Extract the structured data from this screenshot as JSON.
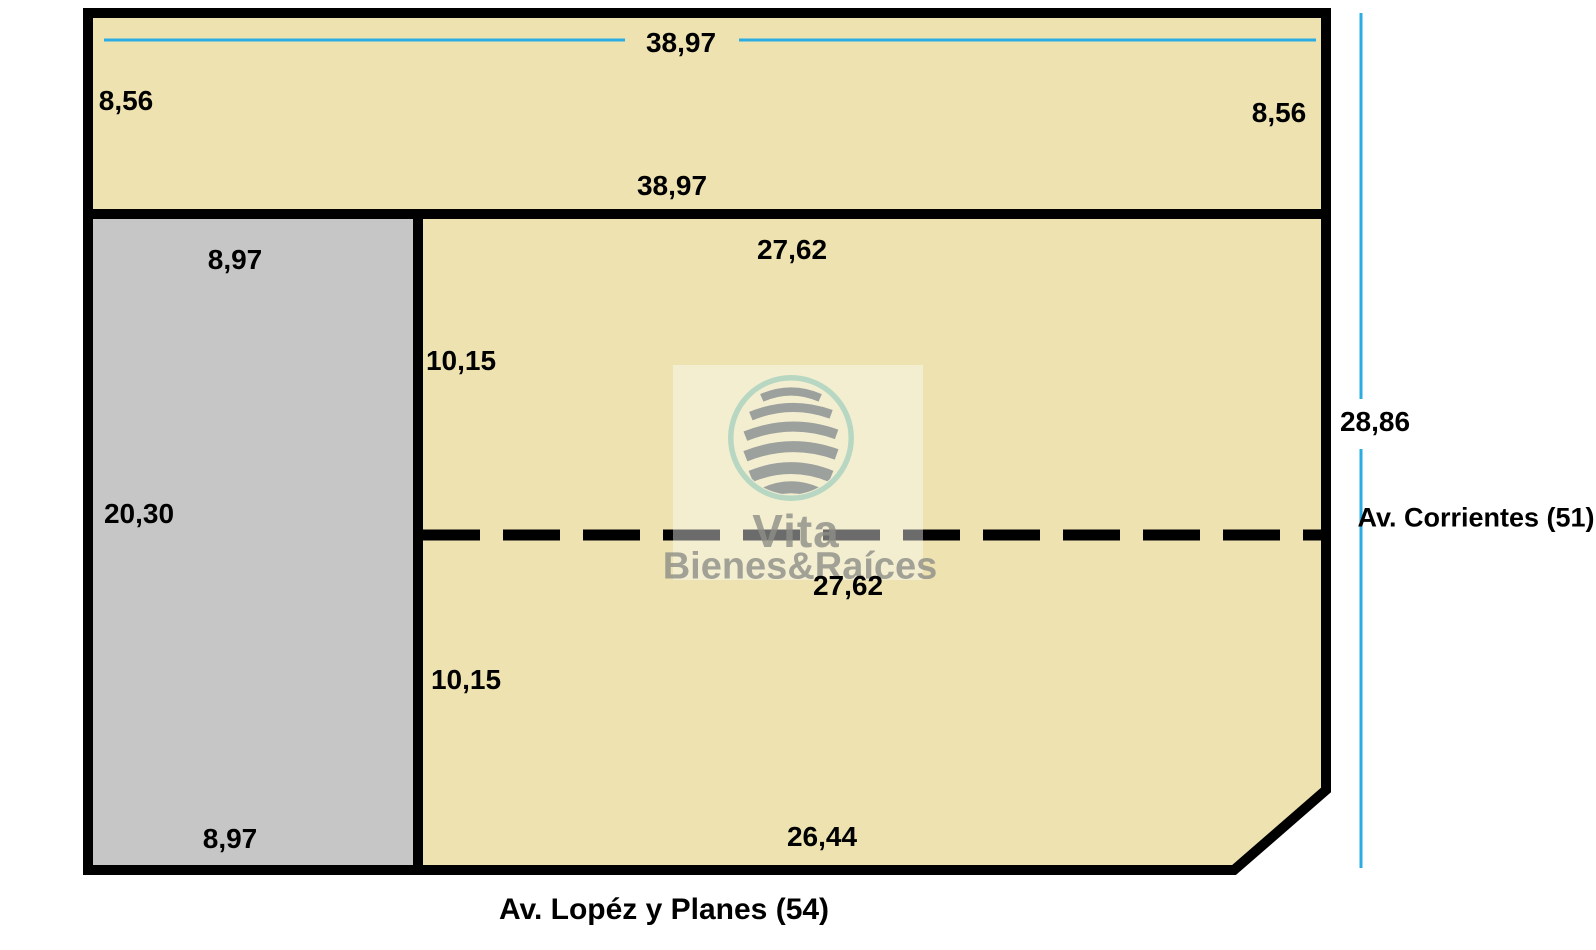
{
  "dimensions": {
    "top_width": "38,97",
    "left_top_height": "8,56",
    "right_top_height": "8,56",
    "strip_bottom_width": "38,97",
    "gray_top_width": "8,97",
    "mid_top_width": "27,62",
    "mid_left_height": "10,15",
    "gray_left_height": "20,30",
    "lower_top_width": "27,62",
    "lower_left_height": "10,15",
    "gray_bottom_width": "8,97",
    "lower_bottom_width": "26,44",
    "right_total_height": "28,86"
  },
  "streets": {
    "right_avenue": "Av. Corrientes (51)",
    "bottom_avenue": "Av. Lopéz y Planes (54)"
  },
  "watermark": {
    "brand": "Vita",
    "subtitle": "Bienes&Raíces"
  },
  "colors": {
    "parcel_fill": "#ede2b0",
    "reserved_fill": "#c6c6c6",
    "outline": "#000000",
    "guide_line": "#2bace2"
  }
}
